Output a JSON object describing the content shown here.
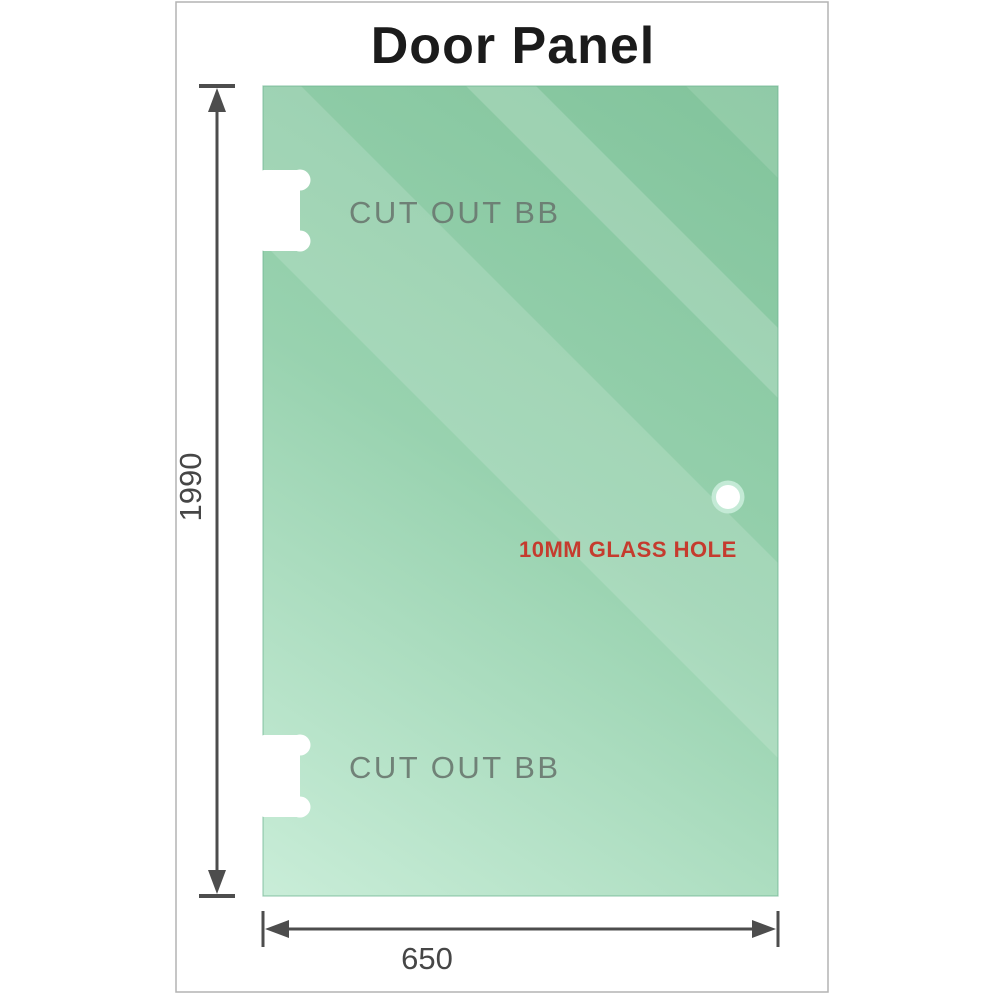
{
  "title": "Door Panel",
  "labels": {
    "cutout_top": "CUT OUT BB",
    "cutout_bottom": "CUT OUT BB",
    "hole": "10MM GLASS HOLE"
  },
  "dimensions": {
    "height": "1990",
    "width": "650"
  },
  "colors": {
    "title": "#1b1b1b",
    "border": "#b3b3b3",
    "glass_dark": "#81c39b",
    "glass_mid": "#98d2af",
    "glass_light": "#c9edd8",
    "glass_edge": "#6fb491",
    "cutout_label": "#6b7a71",
    "hole_label": "#c53b2e",
    "hole_ring": "#c4ead6",
    "dimension_line": "#4d4d4d"
  }
}
